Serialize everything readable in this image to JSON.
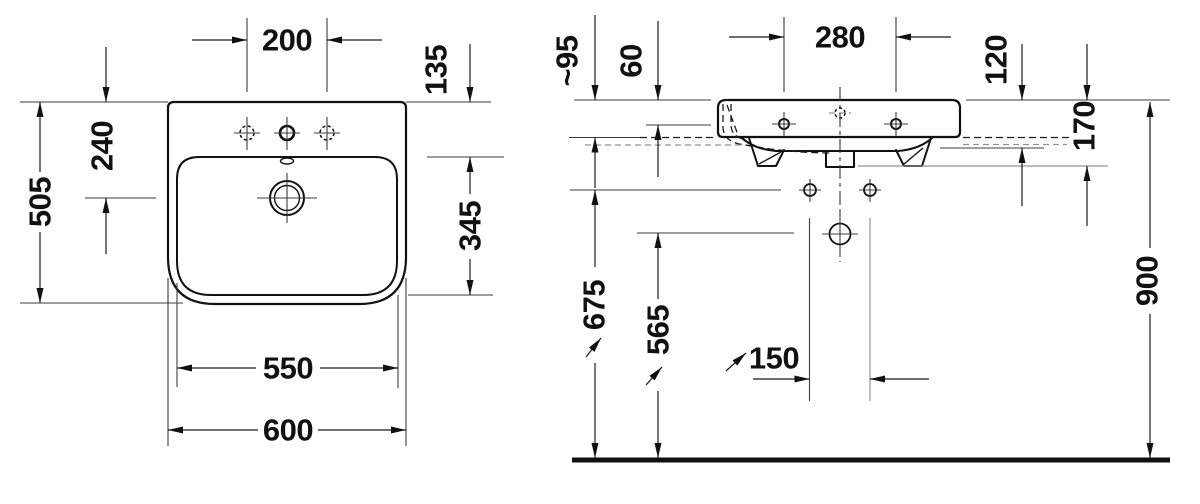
{
  "colors": {
    "ink": "#111111",
    "thin_line": "#3c3c3c",
    "muted_line": "#949494",
    "background": "#ffffff"
  },
  "top_view": {
    "dims": {
      "tap_hole_spacing": "200",
      "rim_to_bowl_front": "135",
      "drain_setback": "240",
      "overall_depth": "505",
      "bowl_depth": "345",
      "bowl_width": "550",
      "overall_width": "600"
    }
  },
  "front_view": {
    "dims": {
      "rim_clearance": "~95",
      "deck_step": "60",
      "tap_hole_spacing": "280",
      "apron_height": "120",
      "body_height": "170",
      "fixing_holes_height": "675",
      "outlet_height": "565",
      "fixing_hole_spacing": "150",
      "rim_height": "900"
    }
  }
}
